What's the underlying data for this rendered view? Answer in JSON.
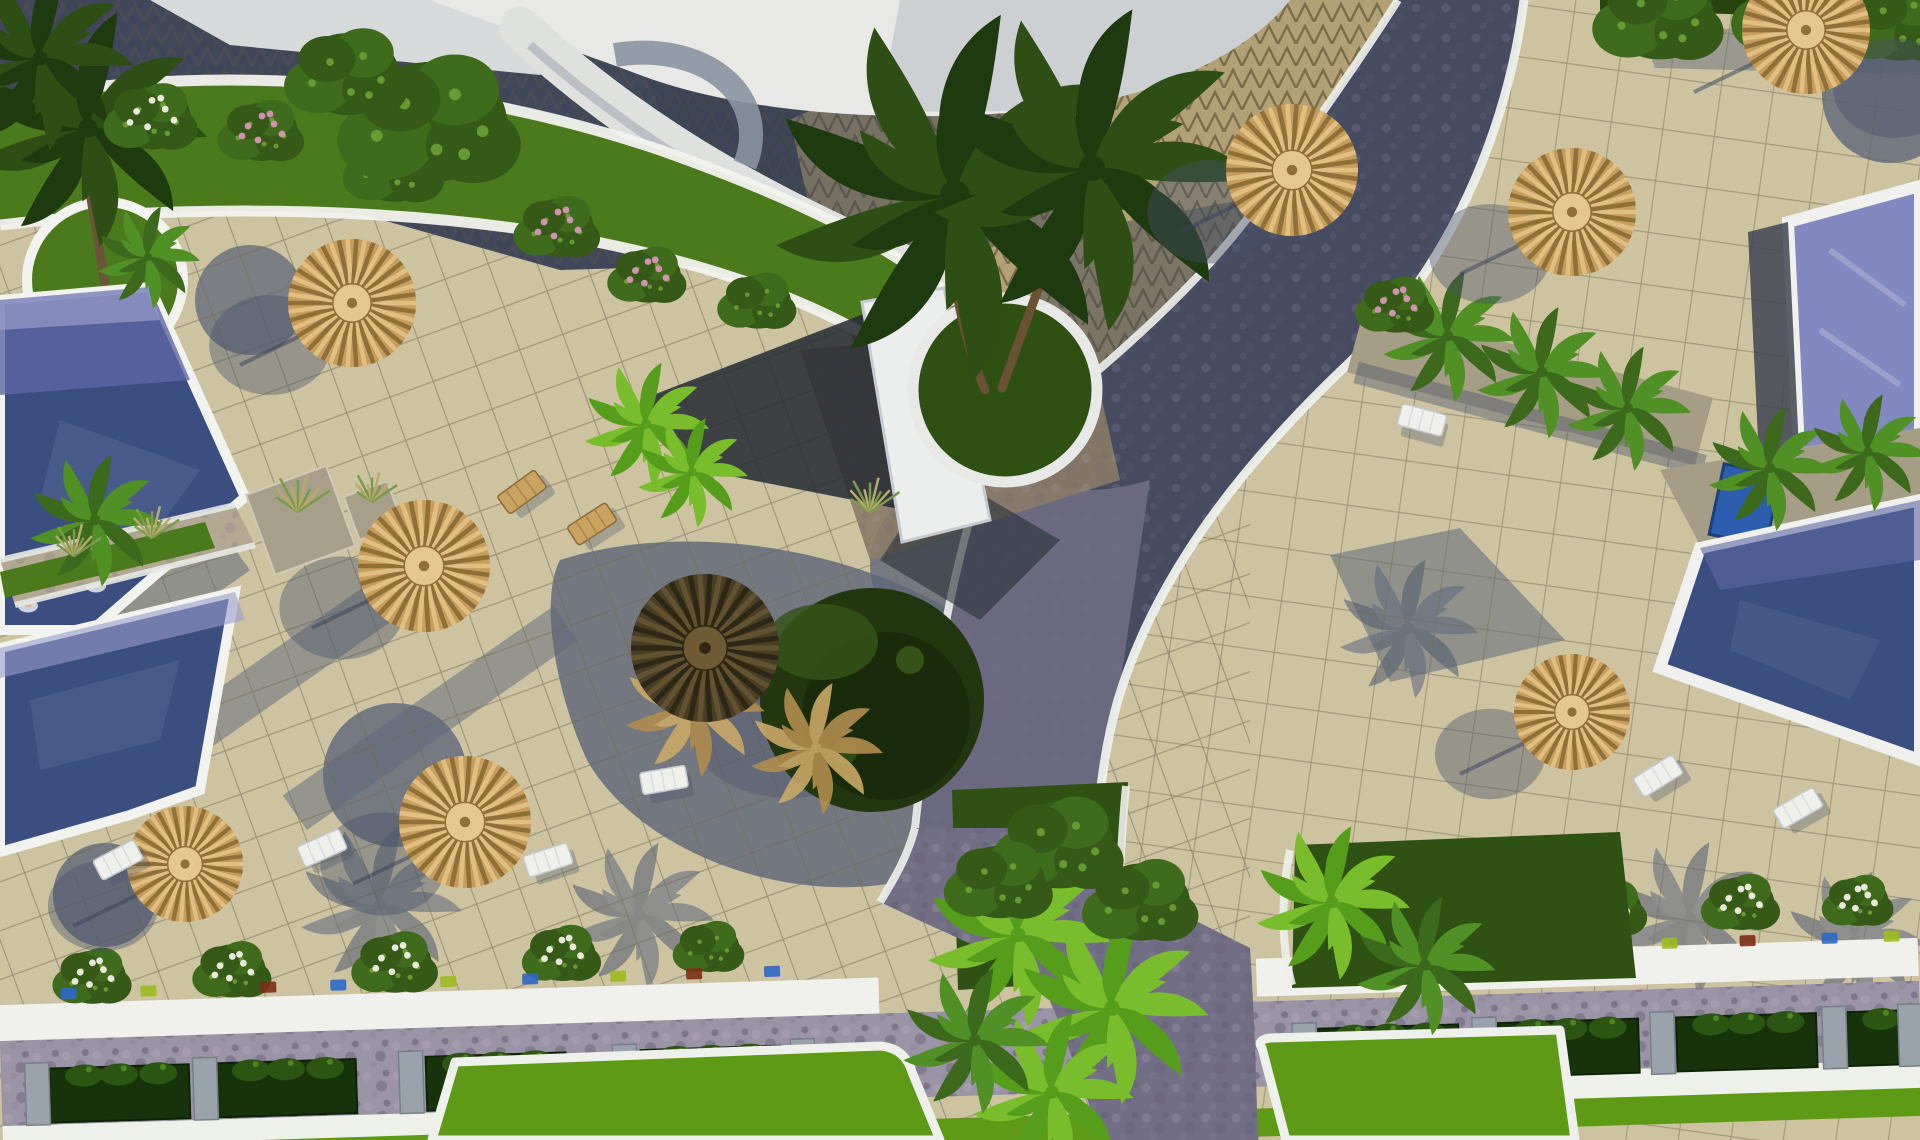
{
  "scene": {
    "type": "aerial-3d-render",
    "subject": "Resort courtyard seen from above: swimming pools, beige tiled sun decks, thatch parasols, sun loungers, palm trees, cobbled paths, planted borders and lawns",
    "lighting": "afternoon sun, long blue-grey shadows cast toward lower-left",
    "palette": {
      "tileSun": "#cdc3a1",
      "tileShade": "#5f6779",
      "grout": "#6f6a54",
      "white": "#f2f2ee",
      "whiteShade": "#ccd0d8",
      "terraceDark": "#41475a",
      "triTan": "#b2a077",
      "triLine": "#6e603e",
      "domeWhite": "#e8e9e6",
      "grassMid": "#4b7a1d",
      "grassDark": "#2e5013",
      "lawnBright": "#5f9a17",
      "leafGreen": "#416a1b",
      "leafBright": "#6fae26",
      "hedgeDark": "#27430f",
      "poolLight": "#8288c0",
      "poolMid": "#5b67a2",
      "poolDark": "#3a4e80",
      "poolLav": "#989dcb",
      "roadDark": "#464b61",
      "roadMid": "#716e86",
      "roadLav": "#9b93a6",
      "roadBrown": "#8b7b66",
      "gravel": "#a69d87",
      "stone": "#98a0ab",
      "shadow": "#46506a",
      "straw": "#c49c5e",
      "strawLight": "#e0bf83",
      "strawDark": "#8a6a38",
      "umbDark": "#4a3d26",
      "accBlue": "#2e68c8",
      "accGreen": "#9dba1e",
      "accRed": "#7c2d16",
      "flowerPink": "#d995bb",
      "flowerWhite": "#f2f1e8"
    },
    "umbrellas": [
      {
        "x": 352,
        "y": 303,
        "r": 64,
        "tone": "light"
      },
      {
        "x": 424,
        "y": 566,
        "r": 66,
        "tone": "light"
      },
      {
        "x": 185,
        "y": 864,
        "r": 58,
        "tone": "light"
      },
      {
        "x": 465,
        "y": 822,
        "r": 66,
        "tone": "light"
      },
      {
        "x": 705,
        "y": 648,
        "r": 74,
        "tone": "dark"
      },
      {
        "x": 1292,
        "y": 170,
        "r": 66,
        "tone": "light"
      },
      {
        "x": 1572,
        "y": 212,
        "r": 64,
        "tone": "light"
      },
      {
        "x": 1806,
        "y": 30,
        "r": 64,
        "tone": "light",
        "sdx": 88,
        "sdy": 58
      },
      {
        "x": 1572,
        "y": 712,
        "r": 58,
        "tone": "light"
      }
    ],
    "palms": [
      {
        "x": 88,
        "y": 128,
        "s": 1.6,
        "tone": "dark"
      },
      {
        "x": 40,
        "y": 58,
        "s": 1.25,
        "tone": "dark"
      },
      {
        "x": 148,
        "y": 257,
        "s": 0.7,
        "tone": "mid"
      },
      {
        "x": 95,
        "y": 520,
        "s": 0.9,
        "tone": "mid"
      },
      {
        "x": 955,
        "y": 195,
        "s": 2.5,
        "tone": "dark"
      },
      {
        "x": 1092,
        "y": 168,
        "s": 2.2,
        "tone": "dark"
      },
      {
        "x": 1448,
        "y": 336,
        "s": 0.9,
        "tone": "mid"
      },
      {
        "x": 1542,
        "y": 372,
        "s": 0.9,
        "tone": "mid"
      },
      {
        "x": 1628,
        "y": 408,
        "s": 0.85,
        "tone": "mid"
      },
      {
        "x": 1770,
        "y": 468,
        "s": 0.85,
        "tone": "mid"
      },
      {
        "x": 1868,
        "y": 452,
        "s": 0.8,
        "tone": "mid"
      },
      {
        "x": 1332,
        "y": 902,
        "s": 1.05,
        "tone": "bright"
      },
      {
        "x": 1425,
        "y": 965,
        "s": 0.95,
        "tone": "mid"
      },
      {
        "x": 1018,
        "y": 935,
        "s": 1.25,
        "tone": "bright"
      },
      {
        "x": 1112,
        "y": 1008,
        "s": 1.3,
        "tone": "bright"
      },
      {
        "x": 1052,
        "y": 1092,
        "s": 1.1,
        "tone": "bright"
      },
      {
        "x": 975,
        "y": 1040,
        "s": 1.0,
        "tone": "mid"
      },
      {
        "x": 694,
        "y": 706,
        "s": 0.95,
        "tone": "straw"
      },
      {
        "x": 816,
        "y": 748,
        "s": 0.9,
        "tone": "straw"
      },
      {
        "x": 646,
        "y": 424,
        "s": 0.85,
        "tone": "bright"
      },
      {
        "x": 692,
        "y": 472,
        "s": 0.75,
        "tone": "bright"
      },
      {
        "x": 380,
        "y": 905,
        "s": 1.1,
        "tone": "shade",
        "layer": "shade"
      },
      {
        "x": 640,
        "y": 915,
        "s": 1.0,
        "tone": "shade",
        "layer": "shade"
      },
      {
        "x": 1690,
        "y": 918,
        "s": 1.05,
        "tone": "shade",
        "layer": "shade"
      },
      {
        "x": 1855,
        "y": 940,
        "s": 0.95,
        "tone": "shade",
        "layer": "shade"
      },
      {
        "x": 1408,
        "y": 628,
        "s": 0.95,
        "tone": "shade",
        "layer": "shade"
      }
    ],
    "bushes": [
      {
        "x": 152,
        "y": 118,
        "s": 1.1,
        "type": "flower-white"
      },
      {
        "x": 262,
        "y": 132,
        "s": 1.0,
        "type": "flower-pink"
      },
      {
        "x": 395,
        "y": 168,
        "s": 1.2,
        "type": "leaf"
      },
      {
        "x": 558,
        "y": 228,
        "s": 1.0,
        "type": "flower-pink"
      },
      {
        "x": 648,
        "y": 276,
        "s": 0.9,
        "type": "flower-pink"
      },
      {
        "x": 758,
        "y": 302,
        "s": 0.9,
        "type": "leaf"
      },
      {
        "x": 432,
        "y": 122,
        "s": 2.3,
        "type": "leaf"
      },
      {
        "x": 348,
        "y": 74,
        "s": 1.5,
        "type": "leaf"
      },
      {
        "x": 1660,
        "y": 16,
        "s": 1.6,
        "type": "leaf"
      },
      {
        "x": 1795,
        "y": 12,
        "s": 1.5,
        "type": "leaf"
      },
      {
        "x": 1900,
        "y": 22,
        "s": 1.4,
        "type": "leaf"
      },
      {
        "x": 1396,
        "y": 306,
        "s": 0.9,
        "type": "flower-pink"
      },
      {
        "x": 1060,
        "y": 845,
        "s": 1.6,
        "type": "leaf"
      },
      {
        "x": 1142,
        "y": 902,
        "s": 1.4,
        "type": "leaf"
      },
      {
        "x": 1000,
        "y": 882,
        "s": 1.3,
        "type": "leaf"
      },
      {
        "x": 298,
        "y": 512,
        "s": 1.0,
        "type": "grass"
      },
      {
        "x": 372,
        "y": 502,
        "s": 0.7,
        "type": "grass"
      },
      {
        "x": 74,
        "y": 556,
        "s": 0.8,
        "type": "grass"
      },
      {
        "x": 152,
        "y": 538,
        "s": 0.8,
        "type": "grass"
      },
      {
        "x": 870,
        "y": 512,
        "s": 0.9,
        "type": "grass"
      },
      {
        "x": 95,
        "y": 950,
        "s": 0.9,
        "type": "flower-white",
        "layer": "band"
      },
      {
        "x": 235,
        "y": 948,
        "s": 0.9,
        "type": "flower-white",
        "layer": "band"
      },
      {
        "x": 398,
        "y": 946,
        "s": 1.0,
        "type": "flower-white",
        "layer": "band"
      },
      {
        "x": 565,
        "y": 942,
        "s": 0.9,
        "type": "flower-white",
        "layer": "band"
      },
      {
        "x": 712,
        "y": 940,
        "s": 0.8,
        "type": "leaf",
        "layer": "band"
      },
      {
        "x": 1352,
        "y": 938,
        "s": 0.9,
        "type": "flower-white",
        "layer": "band"
      },
      {
        "x": 1478,
        "y": 934,
        "s": 0.9,
        "type": "flower-white",
        "layer": "band"
      },
      {
        "x": 1612,
        "y": 930,
        "s": 0.9,
        "type": "flower-white",
        "layer": "band"
      },
      {
        "x": 1745,
        "y": 928,
        "s": 0.9,
        "type": "flower-white",
        "layer": "band"
      },
      {
        "x": 1862,
        "y": 930,
        "s": 0.8,
        "type": "flower-white",
        "layer": "band"
      }
    ],
    "loungers": [
      {
        "x": 118,
        "y": 860,
        "a": -28,
        "tone": "white"
      },
      {
        "x": 322,
        "y": 848,
        "a": -24,
        "tone": "white"
      },
      {
        "x": 548,
        "y": 860,
        "a": -18,
        "tone": "white"
      },
      {
        "x": 664,
        "y": 780,
        "a": -10,
        "tone": "white"
      },
      {
        "x": 1658,
        "y": 776,
        "a": -32,
        "tone": "white"
      },
      {
        "x": 1798,
        "y": 808,
        "a": -30,
        "tone": "white"
      },
      {
        "x": 522,
        "y": 492,
        "a": -36,
        "tone": "straw"
      },
      {
        "x": 592,
        "y": 524,
        "a": -33,
        "tone": "straw"
      },
      {
        "x": 1422,
        "y": 420,
        "a": 15,
        "tone": "white"
      }
    ],
    "planter_row": {
      "left_xs": [
        48,
        215,
        425,
        640
      ],
      "right_xs": [
        1318,
        1498,
        1676,
        1846
      ],
      "box_w": 140,
      "post_xs": [
        24,
        192,
        398,
        612,
        790,
        1292,
        1472,
        1650,
        1822,
        1898
      ]
    },
    "curb_accents": [
      {
        "x": 62,
        "c": "blue"
      },
      {
        "x": 142,
        "c": "green"
      },
      {
        "x": 262,
        "c": "red"
      },
      {
        "x": 332,
        "c": "blue"
      },
      {
        "x": 442,
        "c": "green"
      },
      {
        "x": 524,
        "c": "blue"
      },
      {
        "x": 612,
        "c": "green"
      },
      {
        "x": 688,
        "c": "red"
      },
      {
        "x": 766,
        "c": "blue"
      },
      {
        "x": 1312,
        "c": "green"
      },
      {
        "x": 1392,
        "c": "blue"
      },
      {
        "x": 1512,
        "c": "green"
      },
      {
        "x": 1586,
        "c": "blue"
      },
      {
        "x": 1664,
        "c": "green"
      },
      {
        "x": 1742,
        "c": "red"
      },
      {
        "x": 1824,
        "c": "blue"
      },
      {
        "x": 1886,
        "c": "green"
      }
    ],
    "swimmers": [
      {
        "x": 36,
        "y": 560
      },
      {
        "x": 28,
        "y": 606
      },
      {
        "x": 96,
        "y": 586
      }
    ]
  }
}
